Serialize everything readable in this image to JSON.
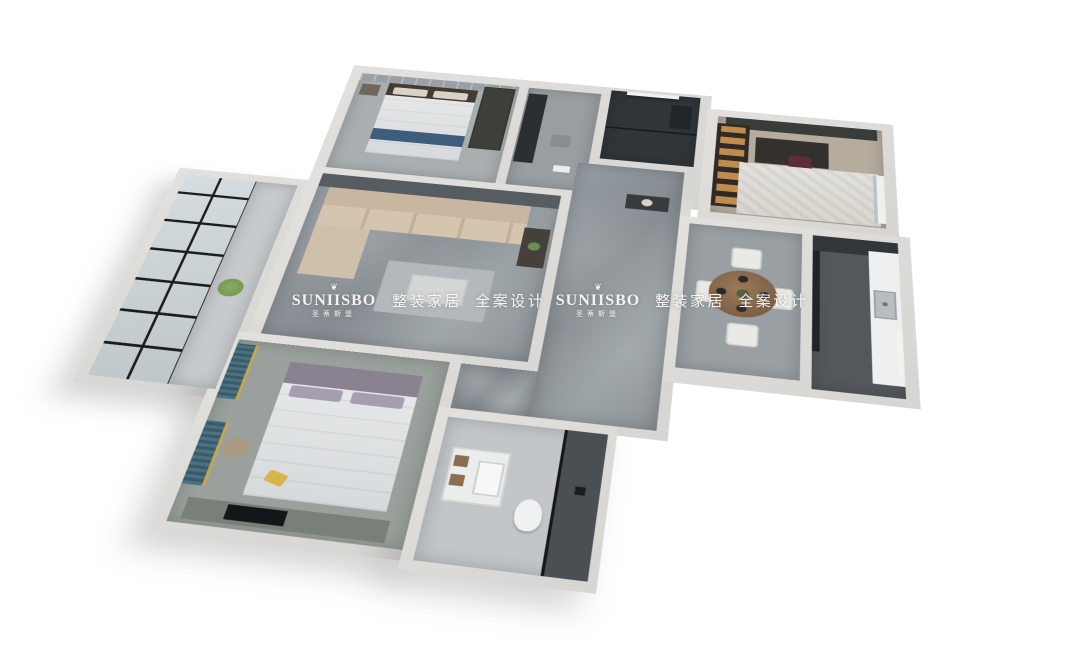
{
  "scene": {
    "type": "3d-isometric-floor-plan-render",
    "background_color": "#ffffff",
    "rooms": [
      "bedroom-secondary",
      "dressing-area",
      "bathroom-dark",
      "study",
      "balcony",
      "living-room",
      "hallway",
      "dining-room",
      "kitchen",
      "master-bedroom",
      "bathroom-main",
      "entry-corridor"
    ]
  },
  "watermark": {
    "ornament": "❦",
    "brand": "SUNIISBO",
    "brand_cn": "圣蒂斯堡",
    "tagline": "整装家居 全案设计",
    "color": "#fbfbfb",
    "instances": 2
  },
  "palette": {
    "wall": "#dadad7",
    "marble_floor": "#8d9398",
    "dark_bath_tile": "#30353a",
    "sofa_beige": "#cdbba4",
    "accent_wall_gray": "#565c61",
    "curtain_teal": "#45707f",
    "pillow_yellow": "#d6b54e",
    "chair_maroon": "#5c2e37",
    "shelf_glow": "#c28b4e",
    "bed_runner_blue": "#3e5c7c",
    "glass_frame_black": "#1b1b1b",
    "wood_table": "#82644a"
  }
}
